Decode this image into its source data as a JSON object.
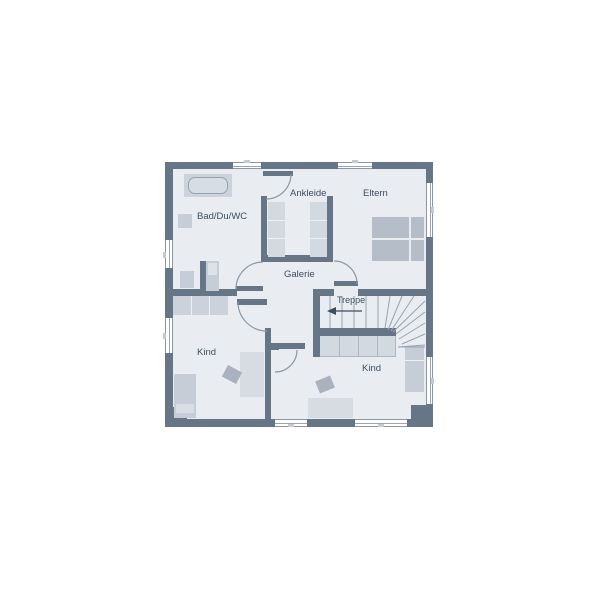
{
  "floorplan": {
    "title": "Obergeschoss Grundriss",
    "rooms": {
      "bad": {
        "label": "Bad/Du/WC"
      },
      "ankleide": {
        "label": "Ankleide"
      },
      "eltern": {
        "label": "Eltern"
      },
      "galerie": {
        "label": "Galerie"
      },
      "treppe": {
        "label": "Treppe"
      },
      "kind_left": {
        "label": "Kind"
      },
      "kind_right": {
        "label": "Kind"
      }
    },
    "stairs": {
      "label": "Treppe",
      "direction_arrow": "left"
    },
    "colors": {
      "background": "#ffffff",
      "wall": "#667687",
      "floor": "#e9edf2",
      "furniture": "#ccd3dc",
      "furniture_dark": "#b4bdc8",
      "thin_line": "#8b97a5",
      "label_text": "#3e4e5e"
    }
  }
}
